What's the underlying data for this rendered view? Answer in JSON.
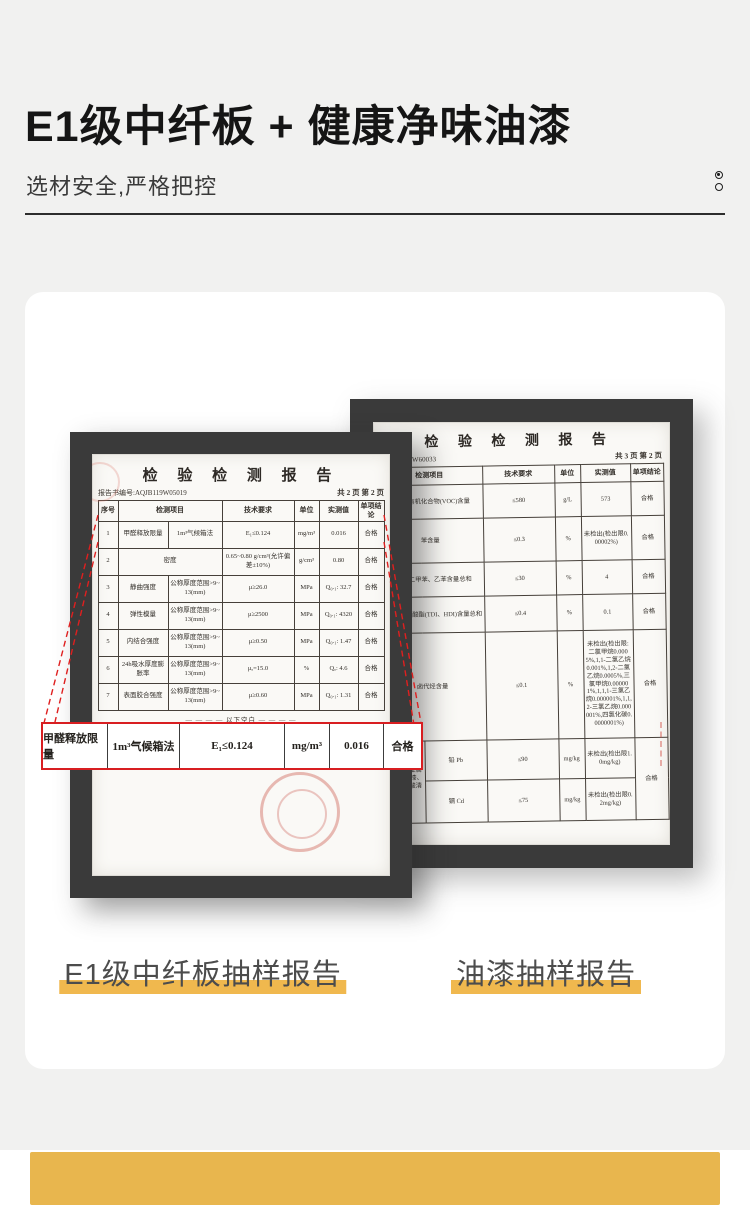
{
  "header": {
    "title": "E1级中纤板 + 健康净味油漆",
    "subtitle": "选材安全,严格把控"
  },
  "captions": {
    "left": "E1级中纤板抽样报告",
    "right": "油漆抽样报告"
  },
  "colors": {
    "accent_yellow": "#F0B84E",
    "callout_red": "#D81E21",
    "frame_dark": "#3A3A3A",
    "page_gray": "#F1F1F0"
  },
  "left_report": {
    "title": "检 验 检 测 报 告",
    "report_no": "报告书编号:AQJB119W05019",
    "page_info": "共 2 页 第 2 页",
    "col_headers": [
      "序号",
      "检测项目",
      "技术要求",
      "单位",
      "实测值",
      "单项结论"
    ],
    "rows": [
      {
        "no": "1",
        "item": "甲醛释放限量",
        "sub": "1m³气候箱法",
        "req": "E₁≤0.124",
        "unit": "mg/m³",
        "value": "0.016",
        "result": "合格"
      },
      {
        "no": "2",
        "item": "密度",
        "req": "0.65~0.80 g/cm³(允许偏差±10%)",
        "unit": "g/cm³",
        "value": "0.80",
        "result": "合格"
      },
      {
        "no": "3",
        "item": "静曲强度",
        "sub": "公称厚度范围>9~13(mm)",
        "req": "μ≥26.0",
        "unit": "MPa",
        "value": "Q₀.₁: 32.7",
        "result": "合格"
      },
      {
        "no": "4",
        "item": "弹性模量",
        "sub": "公称厚度范围>9~13(mm)",
        "req": "μ≥2500",
        "unit": "MPa",
        "value": "Q₀.₁: 4320",
        "result": "合格"
      },
      {
        "no": "5",
        "item": "内结合强度",
        "sub": "公称厚度范围>9~13(mm)",
        "req": "μ≥0.50",
        "unit": "MPa",
        "value": "Q₀.₁: 1.47",
        "result": "合格"
      },
      {
        "no": "6",
        "item": "24h吸水厚度膨胀率",
        "sub": "公称厚度范围>9~13(mm)",
        "req": "μₐ=15.0",
        "unit": "%",
        "value": "Qₐ: 4.6",
        "result": "合格"
      },
      {
        "no": "7",
        "item": "表面胶合强度",
        "sub": "公称厚度范围>9~13(mm)",
        "req": "μ≥0.60",
        "unit": "MPa",
        "value": "Q₀.₁: 1.31",
        "result": "合格"
      }
    ],
    "blank_note": "— — — — 以下空白 — — — —"
  },
  "callout": {
    "cells": [
      "甲醛释放限量",
      "1m³气候箱法",
      "E₁≤0.124",
      "mg/m³",
      "0.016",
      "合格"
    ]
  },
  "right_report": {
    "title": "检 验 检 测 报 告",
    "report_no": "号:ASHA22W60033",
    "page_info": "共 3 页 第 2 页",
    "col_headers": [
      "检测项目",
      "技术要求",
      "单位",
      "实测值",
      "单项结论"
    ],
    "rows": [
      {
        "item": "挥发性有机化合物(VOC)含量",
        "req": "≤580",
        "unit": "g/L",
        "value": "573",
        "result": "合格"
      },
      {
        "item": "苯含量",
        "req": "≤0.3",
        "unit": "%",
        "value": "未检出(检出限0.00002%)",
        "result": "合格"
      },
      {
        "item": "甲苯、二甲苯、乙苯含量总和",
        "req": "≤30",
        "unit": "%",
        "value": "4",
        "result": "合格"
      },
      {
        "item": "游离二异氰酸酯(TDI、HDI)含量总和",
        "req": "≤0.4",
        "unit": "%",
        "value": "0.1",
        "result": "合格"
      },
      {
        "item": "卤代烃含量",
        "req": "≤0.1",
        "unit": "%",
        "value": "未检出(检出限:二氯甲烷0.0005%,1,1-二氯乙烷0.001%,1,2-二氯乙烷0.0005%,三氯甲烷0.000001%,1,1,1-三氯乙烷0.000001%,1,1,2-三氯乙烷0.000001%,四氯化碳0.0000001%)",
        "result": "合格"
      },
      {
        "group": "可溶性重金属含量(限色漆、腻子和醇酸清漆)",
        "sub_rows": [
          {
            "item": "铅 Pb",
            "req": "≤90",
            "unit": "mg/kg",
            "value": "未检出(检出限1.0mg/kg)"
          },
          {
            "item": "镉 Cd",
            "req": "≤75",
            "unit": "mg/kg",
            "value": "未检出(检出限0.2mg/kg)"
          }
        ],
        "result": "合格"
      }
    ]
  }
}
